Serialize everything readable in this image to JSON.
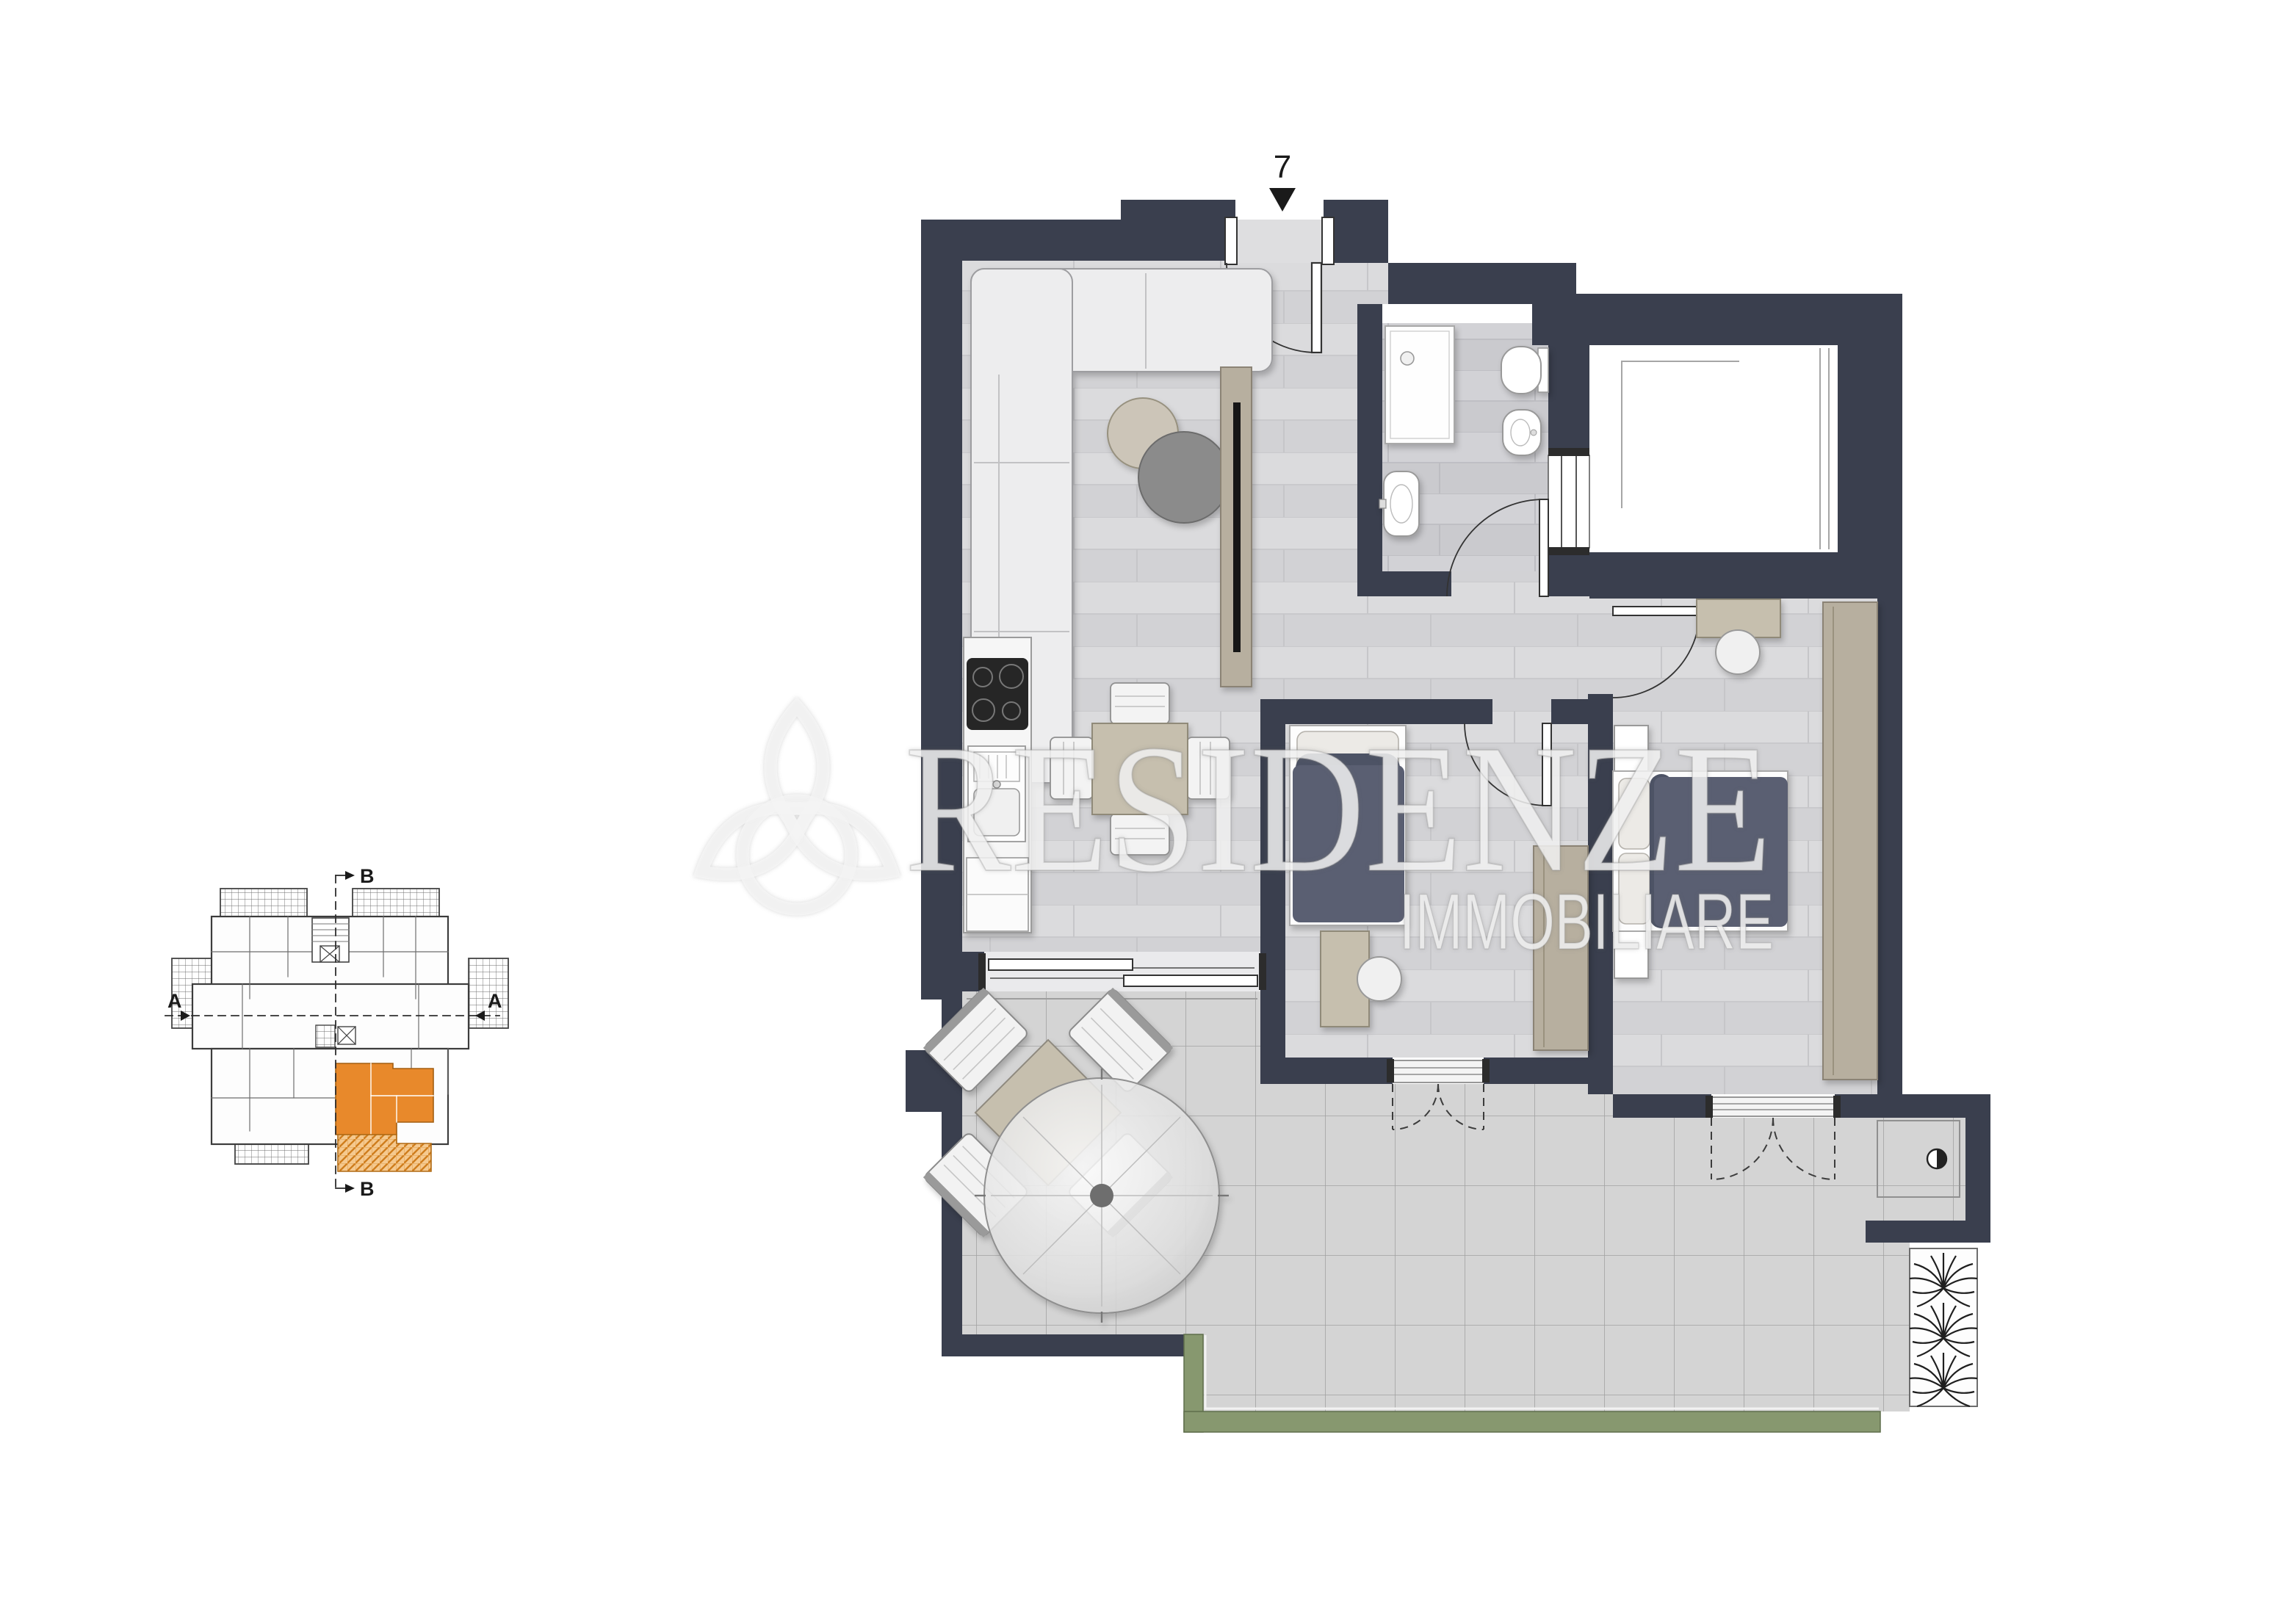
{
  "entrance": {
    "unit_number": "7"
  },
  "watermark": {
    "brand": "RESIDENZE",
    "tagline": "IMMOBILIARE"
  },
  "key_plan": {
    "section_a_label": "A",
    "section_b_label": "B"
  },
  "colors": {
    "wall": "#3a3f4e",
    "highlight_orange": "#e8892b",
    "hedge_green": "#87986f",
    "floor_plank": "#d8d8da",
    "terrace_tile": "#d3d3d3",
    "furniture_taupe": "#b7af9f",
    "bed_dark": "#5a5f72"
  }
}
